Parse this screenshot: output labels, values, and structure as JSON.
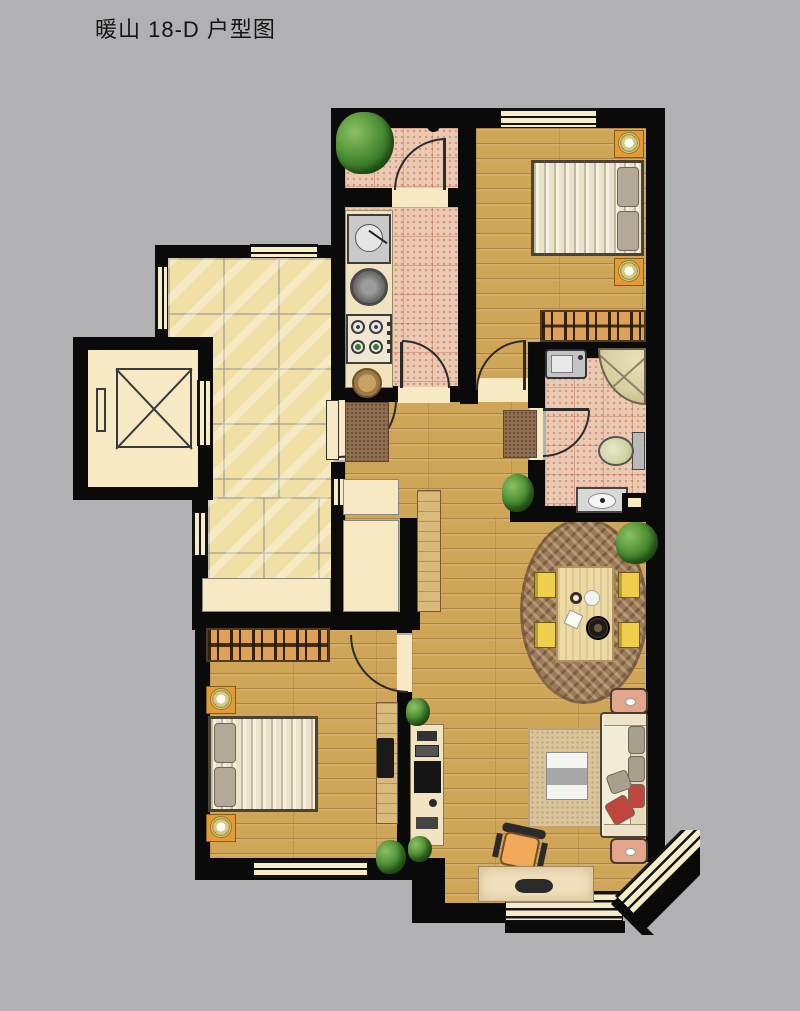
{
  "page": {
    "title": "暖山 18-D 户型图",
    "background": "#b1b1b3"
  },
  "colors": {
    "background": "#b1b1b3",
    "wall": "#0a0a0a",
    "wood": "#cfa558",
    "marble_tile": "#f0e0a6",
    "pink_tile": "#ecc9b2",
    "cream": "#f6e9c3",
    "window": "#f7ecc9",
    "wardrobe": "#dfa057",
    "nightstand": "#e59b35",
    "rug_dining": "#9b7a58",
    "rug_living": "#d9c49c",
    "chair_yellow": "#f0cf4e",
    "sofa": "#f3ecd6",
    "accent_red": "#c0453c",
    "pillow_gray": "#a89e8d",
    "end_table": "#e3a58c",
    "desk_chair": "#f0a95a",
    "furniture_wood": "#d9b97c",
    "plant_green": "#3c7d2c",
    "shower_khaki": "#d8cf9f"
  },
  "rooms": [
    {
      "name": "balcony"
    },
    {
      "name": "kitchen"
    },
    {
      "name": "secondary-bedroom"
    },
    {
      "name": "bathroom"
    },
    {
      "name": "public-corridor"
    },
    {
      "name": "elevator"
    },
    {
      "name": "entry-hall"
    },
    {
      "name": "dining-area"
    },
    {
      "name": "living-room"
    },
    {
      "name": "master-bedroom"
    }
  ],
  "furniture": [
    {
      "name": "double-bed",
      "count": 2
    },
    {
      "name": "nightstand-with-lamp",
      "count": 4
    },
    {
      "name": "wardrobe",
      "count": 2
    },
    {
      "name": "washing-machine"
    },
    {
      "name": "corner-shower"
    },
    {
      "name": "toilet"
    },
    {
      "name": "bathroom-sink"
    },
    {
      "name": "kitchen-sink"
    },
    {
      "name": "gas-stove"
    },
    {
      "name": "dining-table-with-4-chairs"
    },
    {
      "name": "sofa-with-pillows"
    },
    {
      "name": "coffee-table"
    },
    {
      "name": "computer-desk"
    },
    {
      "name": "office-chair"
    },
    {
      "name": "tv-cabinet"
    },
    {
      "name": "elevator-car"
    },
    {
      "name": "potted-plant",
      "count": 5
    }
  ]
}
